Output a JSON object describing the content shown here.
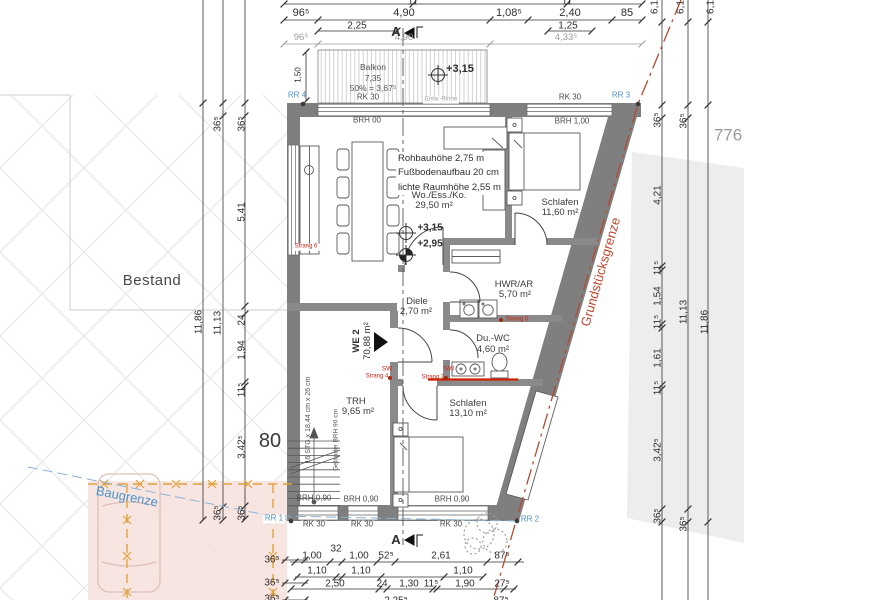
{
  "meta": {
    "bestand": "Bestand",
    "street_number": "80",
    "plot_number": "776"
  },
  "boundaries": {
    "baugrenze_label": "Baugrenze",
    "grundstuecksgrenze_label": "Grundstücksgrenze"
  },
  "section": {
    "marker": "A"
  },
  "unit": {
    "label": "WE 2",
    "area": "70,88 m²"
  },
  "balcony": {
    "text": "Balkon\n7,35\n50% = 3,67⁵",
    "gutter": "Entw.-Rinne",
    "depth": "1,50",
    "level": "+3,15"
  },
  "notes": {
    "heights": "Rohbauhöhe 2,75 m\nFußbodenaufbau 20 cm\nlichte Raumhöhe 2,55 m",
    "levels": {
      "a": "+3,15",
      "b": "+2,95"
    }
  },
  "rooms": {
    "wohnen": {
      "name": "Wo./Ess./Ko.",
      "area": "29,50 m²"
    },
    "schlafen1": {
      "name": "Schlafen",
      "area": "11,60 m²"
    },
    "hwr": {
      "name": "HWR/AR",
      "area": "5,70 m²"
    },
    "duwc": {
      "name": "Du.-WC",
      "area": "4,60 m²"
    },
    "diele": {
      "name": "Diele",
      "area": "2,70 m²"
    },
    "schlafen2": {
      "name": "Schlafen",
      "area": "13,10 m²"
    },
    "trh": {
      "name": "TRH",
      "area": "9,65 m²"
    }
  },
  "stair": {
    "steps": "16 STG x 18,44 cm x 26 cm",
    "railing": "Geländer BRH 90 cm"
  },
  "windows": {
    "rk30": "RK 30",
    "brh00": "BRH 00",
    "brh100": "BRH 1,00",
    "brh090": "BRH 0,90"
  },
  "drainage": {
    "rr1": "RR 1",
    "rr2": "RR 2",
    "rr3": "RR 3",
    "rr4": "RR 4",
    "sw": "SW",
    "strang3": "Strang 3",
    "strang4": "Strang 4",
    "strang5": "Strang 5",
    "strang6": "Strang 6"
  },
  "dims": {
    "top_clip": [
      "11",
      "11"
    ],
    "top1": [
      "96⁵",
      "4,90",
      "1,08⁵",
      "2,40",
      "85"
    ],
    "top2": [
      "2,25",
      "1,25"
    ],
    "gray": [
      "96⁵",
      "4,90",
      "4,33⁵"
    ],
    "right_rot": [
      "6,1",
      "6,1",
      "6,1"
    ],
    "left_outer": "11,86",
    "left_mid": [
      "36⁵",
      "11,13",
      "36⁵"
    ],
    "left_chain": [
      "36⁵",
      "5,41",
      "24",
      "1,94",
      "11⁵",
      "3,42⁵",
      "36⁵"
    ],
    "right_chain": [
      "36⁵",
      "4,21",
      "11⁵",
      "1,54",
      "11⁵",
      "1,61",
      "11⁵",
      "3,42⁵",
      "36⁵"
    ],
    "right_mid": [
      "36⁵",
      "11,13",
      "36⁵"
    ],
    "right_outer": "11,86",
    "bottom1": [
      "1,00",
      "32",
      "1,00",
      "52⁵",
      "2,61",
      "87⁵"
    ],
    "bottom2": [
      "1,10",
      "1,10",
      "1,10"
    ],
    "bottom3": [
      "2,50",
      "24",
      "1,30",
      "11⁵",
      "1,90",
      "27⁵"
    ],
    "bottom4": [
      "2,25⁵",
      "87⁵"
    ],
    "left_small": [
      "36⁵",
      "36⁵",
      "36⁵"
    ]
  }
}
